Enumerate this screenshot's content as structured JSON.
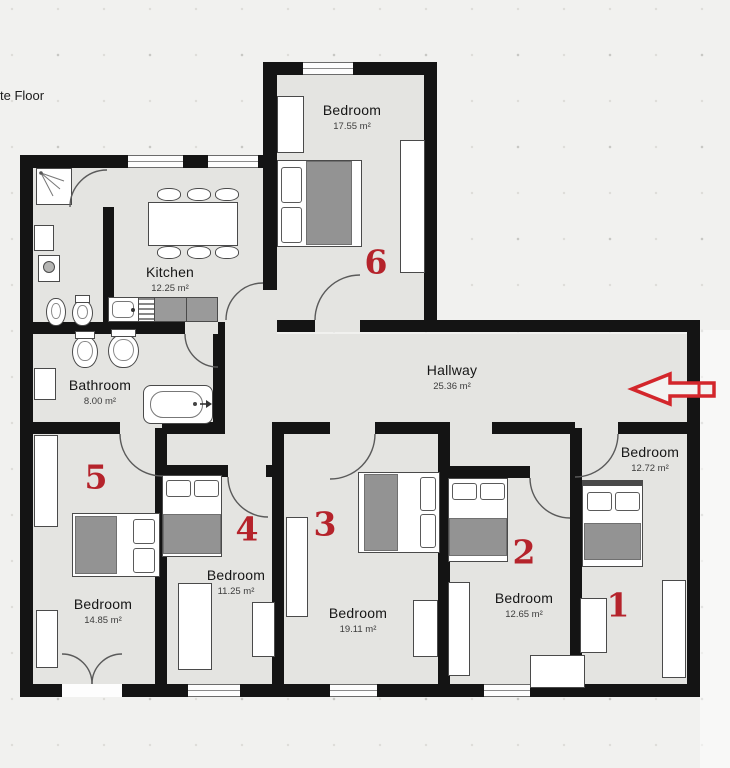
{
  "page": {
    "corner_label": "te Floor"
  },
  "colors": {
    "background": "#f1f1ef",
    "floor": "#e4e4e1",
    "wall": "#141414",
    "annotation_red": "#c8232b"
  },
  "rooms": [
    {
      "id": "bedroom-6",
      "name": "Bedroom",
      "area": "17.55 m²",
      "number": "6"
    },
    {
      "id": "kitchen",
      "name": "Kitchen",
      "area": "12.25 m²"
    },
    {
      "id": "hallway",
      "name": "Hallway",
      "area": "25.36 m²"
    },
    {
      "id": "bathroom",
      "name": "Bathroom",
      "area": "8.00 m²"
    },
    {
      "id": "bedroom-5",
      "name": "Bedroom",
      "area": "14.85 m²",
      "number": "5"
    },
    {
      "id": "bedroom-4",
      "name": "Bedroom",
      "area": "11.25 m²",
      "number": "4"
    },
    {
      "id": "bedroom-3",
      "name": "Bedroom",
      "area": "19.11 m²",
      "number": "3"
    },
    {
      "id": "bedroom-2",
      "name": "Bedroom",
      "area": "12.65 m²",
      "number": "2"
    },
    {
      "id": "bedroom-1",
      "name": "Bedroom",
      "area": "12.72 m²",
      "number": "1"
    }
  ],
  "annotations": {
    "arrow_direction": "left"
  }
}
